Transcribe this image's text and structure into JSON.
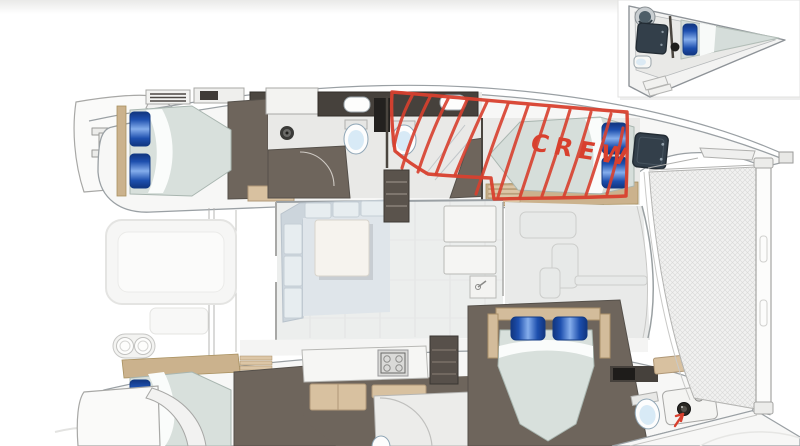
{
  "annotation": {
    "label": "CREW",
    "color": "#d8402e"
  },
  "palette": {
    "background": "#ffffff",
    "hull_fill": "#f7f7f6",
    "hull_line": "#9aa0a4",
    "floor_dark": "#6e655c",
    "wall_dark": "#46413c",
    "wood_trim": "#cbb28d",
    "cabinet_tan": "#d8c1a0",
    "mattress": "#d8e0dc",
    "sheet_white": "#fafcfb",
    "pillow_blue": "#1d4fae",
    "toilet_bowl": "#d8eaf6",
    "sofa": "#dfe5ea",
    "table_white": "#f6f3ee",
    "trampoline_mesh": "#f1f1f0",
    "annotation_red": "#d8402e"
  }
}
